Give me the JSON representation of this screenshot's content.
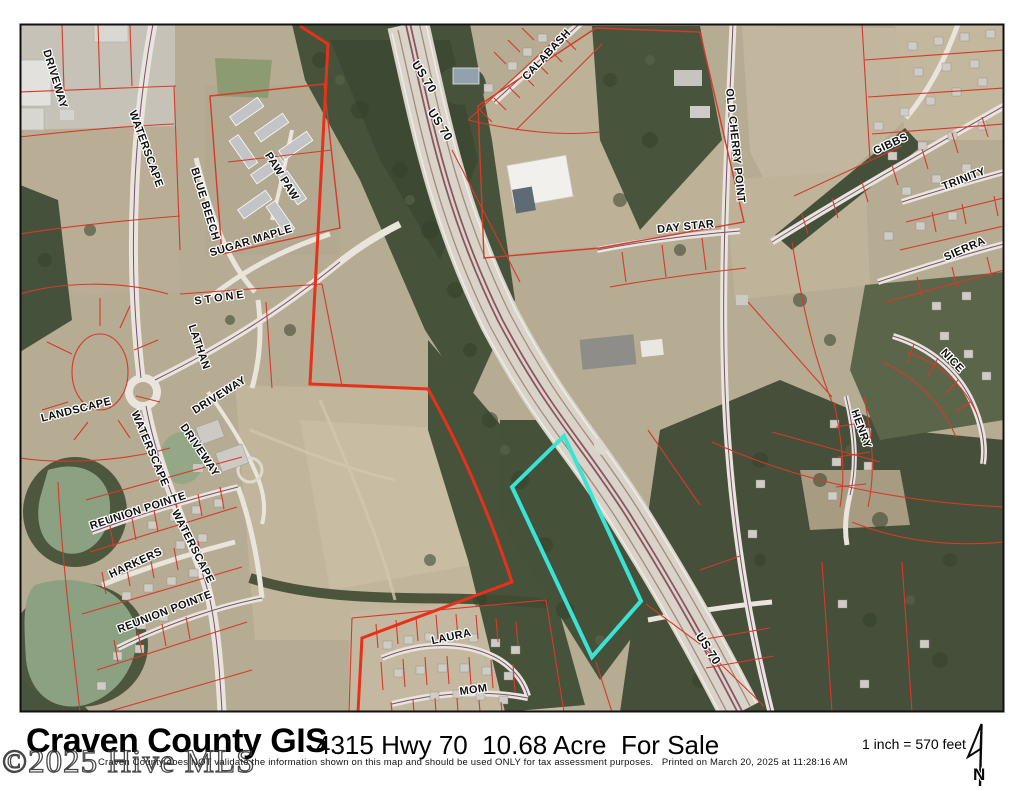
{
  "map": {
    "highlight_color": "#3BE3D4",
    "parcel_line_color": "#D63A28",
    "labels": [
      {
        "text": "DRIVEWAY",
        "x": 52,
        "y": 80,
        "rot": 73
      },
      {
        "text": "WATERSCAPE",
        "x": 143,
        "y": 150,
        "rot": 70
      },
      {
        "text": "BLUE BEECH",
        "x": 202,
        "y": 205,
        "rot": 73
      },
      {
        "text": "PAW PAW",
        "x": 279,
        "y": 178,
        "rot": 58
      },
      {
        "text": "SUGAR MAPLE",
        "x": 252,
        "y": 244,
        "rot": -17
      },
      {
        "text": "STONE",
        "x": 221,
        "y": 301,
        "rot": -8,
        "ls": 3
      },
      {
        "text": "LATHAN",
        "x": 196,
        "y": 348,
        "rot": 71
      },
      {
        "text": "LANDSCAPE",
        "x": 77,
        "y": 413,
        "rot": -14
      },
      {
        "text": "DRIVEWAY",
        "x": 221,
        "y": 398,
        "rot": -32
      },
      {
        "text": "DRIVEWAY",
        "x": 197,
        "y": 452,
        "rot": 56
      },
      {
        "text": "WATERSCAPE",
        "x": 147,
        "y": 450,
        "rot": 67
      },
      {
        "text": "REUNION POINTE",
        "x": 139,
        "y": 514,
        "rot": -18
      },
      {
        "text": "WATERSCAPE",
        "x": 190,
        "y": 548,
        "rot": 63
      },
      {
        "text": "HARKERS",
        "x": 137,
        "y": 566,
        "rot": -25
      },
      {
        "text": "REUNION POINTE",
        "x": 166,
        "y": 615,
        "rot": -21
      },
      {
        "text": "LAURA",
        "x": 452,
        "y": 640,
        "rot": -12
      },
      {
        "text": "MOM",
        "x": 474,
        "y": 693,
        "rot": -8
      },
      {
        "text": "CALABASH",
        "x": 549,
        "y": 57,
        "rot": -47
      },
      {
        "text": "US 70",
        "x": 421,
        "y": 79,
        "rot": 57,
        "size": 12
      },
      {
        "text": "US 70",
        "x": 437,
        "y": 127,
        "rot": 57,
        "size": 12
      },
      {
        "text": "OLD CHERRY POINT",
        "x": 732,
        "y": 146,
        "rot": 84
      },
      {
        "text": "DAY STAR",
        "x": 686,
        "y": 230,
        "rot": -6
      },
      {
        "text": "GIBBS",
        "x": 892,
        "y": 147,
        "rot": -25
      },
      {
        "text": "TRINITY",
        "x": 965,
        "y": 182,
        "rot": -21
      },
      {
        "text": "SIERRA",
        "x": 966,
        "y": 252,
        "rot": -24
      },
      {
        "text": "NICE",
        "x": 950,
        "y": 363,
        "rot": 46
      },
      {
        "text": "HENRY",
        "x": 858,
        "y": 430,
        "rot": 70
      },
      {
        "text": "US 70",
        "x": 705,
        "y": 651,
        "rot": 57,
        "size": 12
      }
    ]
  },
  "footer": {
    "title": "Craven County GIS",
    "subtitle": "4315 Hwy 70  10.68 Acre  For Sale",
    "disclaimer": "Craven County does NOT validate the information shown on this map and should be used ONLY for tax assessment purposes.   Printed on March 20, 2025 at 11:28:16 AM",
    "scale_text": "1 inch = 570 feet",
    "north_label": "N"
  },
  "watermark": {
    "text": "©2025 Hive MLS"
  }
}
